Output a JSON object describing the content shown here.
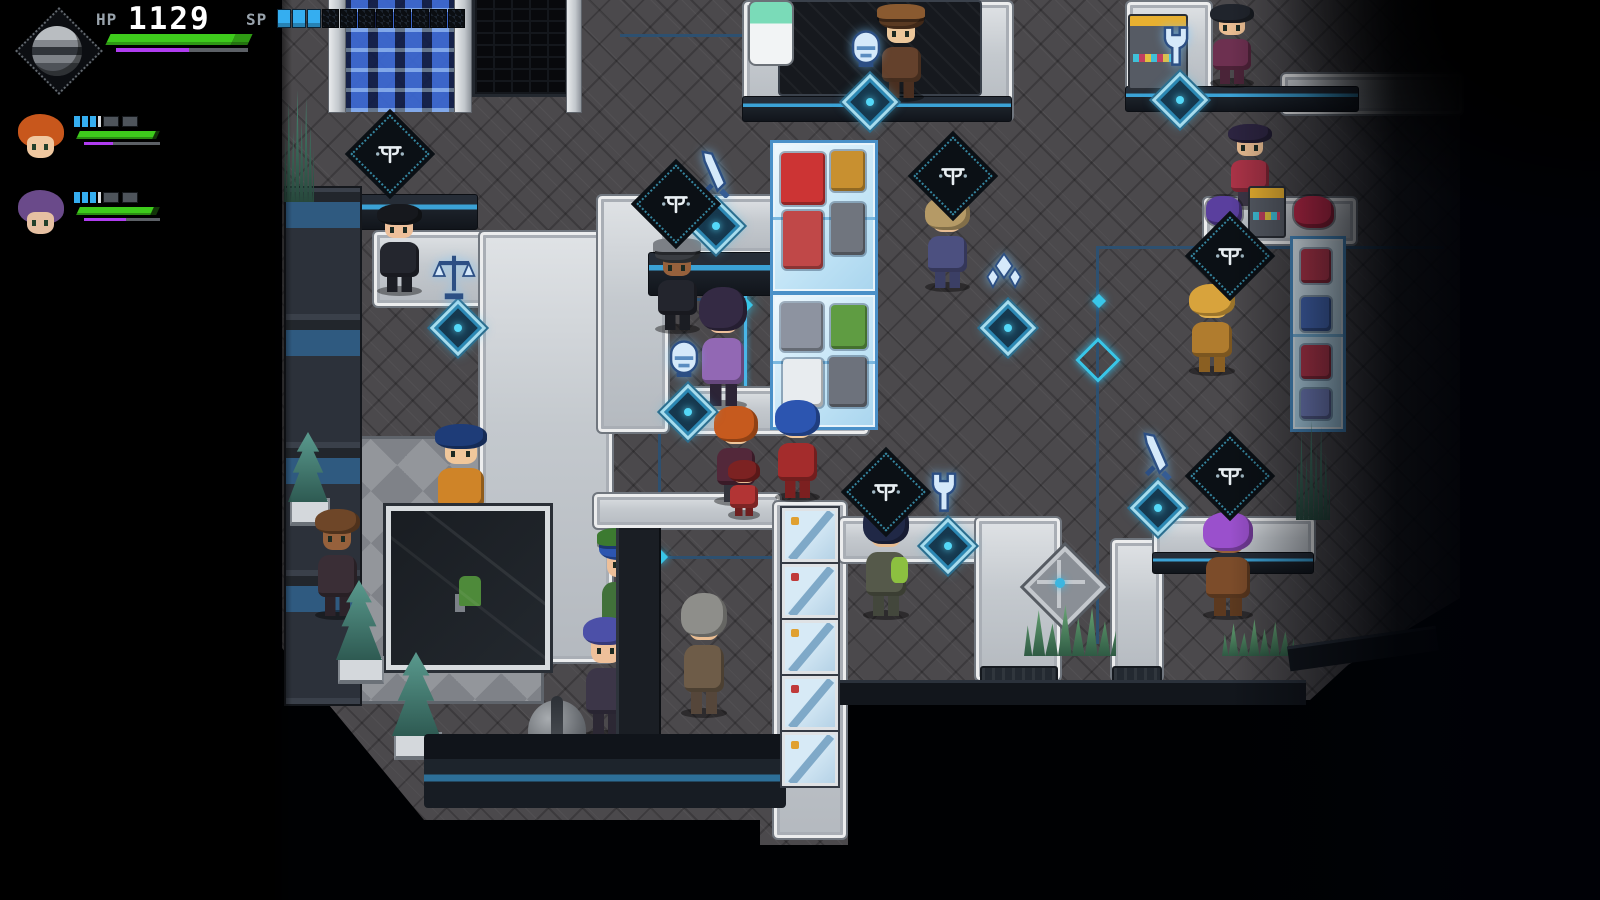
{
  "hud": {
    "hp_label": "HP",
    "hp_value": "1129",
    "sp_label": "SP",
    "hp_percent": 100,
    "buff_percent": 55,
    "sp_segments_filled": 3,
    "sp_segments_empty": 8,
    "colors": {
      "hp_bar": "#3ecb1c",
      "hp_bar_tip": "#2f9a14",
      "buff_bar": "#b03cf0",
      "bar_track": "#5c6066",
      "sp_filled": "#35aef0",
      "label_text": "#99a3ac",
      "value_text": "#ffffff"
    },
    "emblem_icon": "planet-emblem",
    "party": [
      {
        "id": "party-member-1",
        "hair": "#c8571c",
        "skin": "#f0c8a0",
        "sp_filled": 3,
        "sp_blocks": 2,
        "hp_percent": 95,
        "buff_percent": 38
      },
      {
        "id": "party-member-2",
        "hair": "#6a4a8a",
        "skin": "#e6c0a2",
        "sp_filled": 3,
        "sp_blocks": 2,
        "hp_percent": 93,
        "buff_percent": 55
      }
    ]
  },
  "scene": {
    "palette": {
      "floor": "#4b494c",
      "walkway": "#c6cad0",
      "accent_cyan": "#49b6e8",
      "glass": "#bfe4f7",
      "hologram": "#cfe4f6"
    },
    "paths": [
      {
        "x": 742,
        "y": 0,
        "w": 268,
        "h": 118
      },
      {
        "x": 778,
        "y": 0,
        "w": 200,
        "h": 92,
        "dark": true
      },
      {
        "x": 742,
        "y": 96,
        "w": 268,
        "h": 24,
        "front": true
      },
      {
        "x": 372,
        "y": 230,
        "w": 238,
        "h": 74
      },
      {
        "x": 478,
        "y": 230,
        "w": 132,
        "h": 430
      },
      {
        "x": 298,
        "y": 194,
        "w": 178,
        "h": 34,
        "front": true
      },
      {
        "x": 596,
        "y": 194,
        "w": 266,
        "h": 58
      },
      {
        "x": 596,
        "y": 194,
        "w": 70,
        "h": 236
      },
      {
        "x": 648,
        "y": 252,
        "w": 140,
        "h": 42,
        "front": true
      },
      {
        "x": 680,
        "y": 386,
        "w": 186,
        "h": 46
      },
      {
        "x": 592,
        "y": 492,
        "w": 186,
        "h": 34
      },
      {
        "x": 772,
        "y": 500,
        "w": 72,
        "h": 336
      },
      {
        "x": 838,
        "y": 516,
        "w": 186,
        "h": 44
      },
      {
        "x": 974,
        "y": 516,
        "w": 84,
        "h": 162
      },
      {
        "x": 980,
        "y": 666,
        "w": 74,
        "h": 24,
        "cap": true
      },
      {
        "x": 1110,
        "y": 538,
        "w": 50,
        "h": 140
      },
      {
        "x": 1112,
        "y": 666,
        "w": 46,
        "h": 22,
        "cap": true
      },
      {
        "x": 1152,
        "y": 516,
        "w": 160,
        "h": 44
      },
      {
        "x": 1152,
        "y": 552,
        "w": 160,
        "h": 20,
        "front": true
      },
      {
        "x": 1202,
        "y": 196,
        "w": 152,
        "h": 46
      },
      {
        "x": 1125,
        "y": 0,
        "w": 84,
        "h": 96
      },
      {
        "x": 1125,
        "y": 86,
        "w": 232,
        "h": 24,
        "front": true
      },
      {
        "x": 1280,
        "y": 72,
        "w": 180,
        "h": 40
      }
    ],
    "lines": [
      {
        "x": 620,
        "y": 34,
        "w": 126,
        "h": 3
      },
      {
        "x": 742,
        "y": 34,
        "w": 3,
        "h": 84
      },
      {
        "x": 744,
        "y": 214,
        "w": 3,
        "h": 196,
        "bright": true
      },
      {
        "x": 558,
        "y": 298,
        "w": 188,
        "h": 3
      },
      {
        "x": 658,
        "y": 298,
        "w": 3,
        "h": 262
      },
      {
        "x": 1096,
        "y": 246,
        "w": 348,
        "h": 3
      },
      {
        "x": 1096,
        "y": 246,
        "w": 3,
        "h": 398
      },
      {
        "x": 660,
        "y": 556,
        "w": 180,
        "h": 3
      },
      {
        "x": 430,
        "y": 762,
        "w": 356,
        "h": 5
      }
    ],
    "nodes": [
      {
        "x": 741,
        "y": 300,
        "bright": true
      },
      {
        "x": 1082,
        "y": 344,
        "big": true
      },
      {
        "x": 1094,
        "y": 296
      },
      {
        "x": 656,
        "y": 552
      }
    ],
    "signs": [
      {
        "icon": "shop-glyph",
        "x": 362,
        "y": 126
      },
      {
        "icon": "shop-glyph",
        "x": 648,
        "y": 176
      },
      {
        "icon": "sword",
        "x": 688,
        "y": 150,
        "medallion": true
      },
      {
        "icon": "shop-glyph",
        "x": 925,
        "y": 148
      },
      {
        "icon": "crystal",
        "x": 980,
        "y": 252,
        "medallion": true
      },
      {
        "icon": "pod",
        "x": 660,
        "y": 336,
        "medallion": true
      },
      {
        "icon": "pod",
        "x": 842,
        "y": 26,
        "medallion": true
      },
      {
        "icon": "wrench",
        "x": 1152,
        "y": 24,
        "medallion": true
      },
      {
        "icon": "shop-glyph",
        "x": 1202,
        "y": 228
      },
      {
        "icon": "scales",
        "x": 430,
        "y": 252,
        "medallion": true
      },
      {
        "icon": "shop-glyph",
        "x": 858,
        "y": 464
      },
      {
        "icon": "wrench",
        "x": 920,
        "y": 470,
        "medallion": true
      },
      {
        "icon": "sword",
        "x": 1130,
        "y": 432,
        "medallion": true
      },
      {
        "icon": "shop-glyph",
        "x": 1202,
        "y": 448
      }
    ],
    "cases": [
      {
        "x": 770,
        "y": 140,
        "w": 102,
        "h": 148,
        "items": [
          {
            "x": 8,
            "y": 10,
            "w": 44,
            "h": 52,
            "c": "#cc3434"
          },
          {
            "x": 58,
            "y": 8,
            "w": 34,
            "h": 40,
            "c": "#c89030"
          },
          {
            "x": 10,
            "y": 68,
            "w": 40,
            "h": 58,
            "c": "#c04848"
          },
          {
            "x": 58,
            "y": 60,
            "w": 34,
            "h": 52,
            "c": "#70757e"
          }
        ]
      },
      {
        "x": 770,
        "y": 292,
        "w": 102,
        "h": 132,
        "items": [
          {
            "x": 8,
            "y": 8,
            "w": 42,
            "h": 48,
            "c": "#8d93a0"
          },
          {
            "x": 58,
            "y": 10,
            "w": 36,
            "h": 44,
            "c": "#5f9c42"
          },
          {
            "x": 10,
            "y": 64,
            "w": 40,
            "h": 48,
            "c": "#e8ecef"
          },
          {
            "x": 56,
            "y": 62,
            "w": 38,
            "h": 50,
            "c": "#6d727c"
          }
        ]
      },
      {
        "x": 1290,
        "y": 236,
        "w": 50,
        "h": 190,
        "items": [
          {
            "x": 8,
            "y": 10,
            "w": 30,
            "h": 34,
            "c": "#c03a50"
          },
          {
            "x": 8,
            "y": 58,
            "w": 30,
            "h": 34,
            "c": "#4a6fc0"
          },
          {
            "x": 8,
            "y": 106,
            "w": 30,
            "h": 34,
            "c": "#c03a50"
          },
          {
            "x": 8,
            "y": 150,
            "w": 30,
            "h": 30,
            "c": "#7a87c8"
          }
        ]
      }
    ],
    "posters": {
      "x": 782,
      "y": 508,
      "count": 5
    },
    "npcs": [
      {
        "name": "green-soldier",
        "x": 1438,
        "y": 0,
        "w": 36,
        "h": 62,
        "hair": "#3f6a2c",
        "skin": "#d8b088",
        "body": "#2f5226",
        "legs": "#233c1c",
        "face": false
      },
      {
        "name": "hat-merchant",
        "x": 876,
        "y": 4,
        "w": 50,
        "h": 98,
        "hair": "#5a3a22",
        "skin": "#ecc79b",
        "body": "#64412c",
        "legs": "#4a2f20",
        "face": true,
        "hat": "#8a5a30"
      },
      {
        "name": "top-right-clerk",
        "x": 1208,
        "y": 0,
        "w": 48,
        "h": 88,
        "hair": "#20242c",
        "skin": "#eabd92",
        "body": "#6d3050",
        "legs": "#4a2438",
        "face": true
      },
      {
        "name": "red-shirt-clerk",
        "x": 1226,
        "y": 120,
        "w": 48,
        "h": 90,
        "hair": "#2c2440",
        "skin": "#eabd92",
        "body": "#ab3347",
        "legs": "#3c3646",
        "face": true
      },
      {
        "name": "long-hair-clerk",
        "x": 374,
        "y": 200,
        "w": 50,
        "h": 96,
        "hair": "#16181d",
        "skin": "#eec09a",
        "body": "#24262e",
        "legs": "#1c1e24",
        "face": true
      },
      {
        "name": "suit-clerk",
        "x": 652,
        "y": 238,
        "w": 50,
        "h": 96,
        "hair": "#3a3d42",
        "skin": "#96613c",
        "body": "#23252d",
        "legs": "#1b1d23",
        "face": true,
        "hat": "#7c8086"
      },
      {
        "name": "sandy-hair-man",
        "x": 922,
        "y": 192,
        "w": 50,
        "h": 100,
        "hair": "#b59a66",
        "skin": "#e8bd92",
        "body": "#4c5080",
        "legs": "#3b3f65",
        "face": false
      },
      {
        "name": "purple-coat-lady",
        "x": 696,
        "y": 282,
        "w": 54,
        "h": 128,
        "hair": "#342a44",
        "skin": "#eec09a",
        "body": "#9268b4",
        "legs": "#2c2436",
        "face": false
      },
      {
        "name": "gold-bird-creature",
        "x": 1186,
        "y": 280,
        "w": 52,
        "h": 96,
        "hair": "#d8a33c",
        "skin": "#e0b050",
        "body": "#b07c2e",
        "legs": "#8a5f22",
        "face": false
      },
      {
        "name": "player-lea",
        "x": 712,
        "y": 402,
        "w": 48,
        "h": 104,
        "hair": "#c65a1e",
        "skin": "#f0c79b",
        "body": "#53283a",
        "legs": "#32343c",
        "face": false
      },
      {
        "name": "blue-hair-ally",
        "x": 772,
        "y": 396,
        "w": 50,
        "h": 106,
        "hair": "#2c55b0",
        "skin": "#f0c79b",
        "body": "#a42c2c",
        "legs": "#7c2020",
        "face": false
      },
      {
        "name": "blue-afro-clerk",
        "x": 432,
        "y": 420,
        "w": 58,
        "h": 110,
        "hair": "#1e3c78",
        "skin": "#f0c79b",
        "body": "#cf8428",
        "legs": "#2c2c30",
        "face": true
      },
      {
        "name": "tiny-red-npc",
        "x": 726,
        "y": 458,
        "w": 36,
        "h": 62,
        "hair": "#7c2222",
        "skin": "#eabd92",
        "body": "#b23434",
        "legs": "#6e1f1f",
        "face": false
      },
      {
        "name": "green-bag-man",
        "x": 860,
        "y": 498,
        "w": 52,
        "h": 122,
        "hair": "#202846",
        "skin": "#e8bd92",
        "body": "#55594a",
        "legs": "#43473c",
        "face": false,
        "extra": "#8cc040"
      },
      {
        "name": "brown-bob-npc",
        "x": 312,
        "y": 504,
        "w": 50,
        "h": 116,
        "hair": "#6e4628",
        "skin": "#96613c",
        "body": "#3a2e36",
        "legs": "#2c232a",
        "face": true
      },
      {
        "name": "green-cap-npc",
        "x": 596,
        "y": 528,
        "w": 52,
        "h": 122,
        "hair": "#2c55b0",
        "skin": "#eec09a",
        "body": "#41713a",
        "legs": "#31542c",
        "face": true,
        "hat": "#3c7a30"
      },
      {
        "name": "purple-spiky-npc",
        "x": 1200,
        "y": 508,
        "w": 56,
        "h": 112,
        "hair": "#9a50cc",
        "skin": "#96613c",
        "body": "#7c4c2a",
        "legs": "#5c391f",
        "face": false
      },
      {
        "name": "blue-hair-girl",
        "x": 580,
        "y": 612,
        "w": 52,
        "h": 128,
        "hair": "#4c50a8",
        "skin": "#eec09a",
        "body": "#3c3648",
        "legs": "#2c2834",
        "face": true
      },
      {
        "name": "gray-coat-walker",
        "x": 678,
        "y": 588,
        "w": 52,
        "h": 130,
        "hair": "#8e8e8a",
        "skin": "#eabd92",
        "body": "#6e5c48",
        "legs": "#55463a",
        "face": false
      }
    ],
    "entity_bars": [
      {
        "x": 713,
        "y": 407,
        "w": 48
      },
      {
        "x": 720,
        "y": 520,
        "w": 48
      }
    ],
    "plants": [
      {
        "type": "pine",
        "x": 288,
        "y": 432,
        "w": 40,
        "h": 70
      },
      {
        "type": "pine",
        "x": 336,
        "y": 580,
        "w": 46,
        "h": 80
      },
      {
        "type": "pine",
        "x": 392,
        "y": 652,
        "w": 48,
        "h": 84
      },
      {
        "type": "tall",
        "x": 284,
        "y": 80,
        "w": 30,
        "h": 122
      },
      {
        "type": "tall",
        "x": 1296,
        "y": 412,
        "w": 34,
        "h": 108
      },
      {
        "type": "grass",
        "x": 648,
        "y": 752,
        "w": 96,
        "h": 40
      },
      {
        "type": "grass",
        "x": 1024,
        "y": 600,
        "w": 92,
        "h": 56,
        "planter": true
      },
      {
        "type": "grass",
        "x": 1222,
        "y": 616,
        "w": 72,
        "h": 40
      }
    ],
    "props": [
      {
        "type": "platform",
        "x": 316,
        "y": 436,
        "w": 222,
        "h": 262
      },
      {
        "type": "plantcase",
        "x": 386,
        "y": 506,
        "w": 154,
        "h": 154
      },
      {
        "type": "bench",
        "x": 424,
        "y": 734,
        "w": 362,
        "h": 74
      },
      {
        "type": "kiosks",
        "x": 284,
        "y": 186,
        "w": 74,
        "h": 516
      },
      {
        "type": "pillar",
        "x": 328,
        "y": 0,
        "w": 16,
        "h": 112
      },
      {
        "type": "crystals",
        "x": 346,
        "y": 0,
        "w": 108,
        "h": 112
      },
      {
        "type": "pillar",
        "x": 454,
        "y": 0,
        "w": 16,
        "h": 112
      },
      {
        "type": "doorway",
        "x": 472,
        "y": 0,
        "w": 92,
        "h": 94
      },
      {
        "type": "pillar",
        "x": 566,
        "y": 0,
        "w": 14,
        "h": 112
      },
      {
        "type": "capsule",
        "x": 748,
        "y": 0,
        "w": 42,
        "h": 62
      },
      {
        "type": "machine",
        "x": 1128,
        "y": 14,
        "w": 56,
        "h": 72
      },
      {
        "type": "machine",
        "x": 1248,
        "y": 186,
        "w": 34,
        "h": 48
      },
      {
        "type": "blob",
        "x": 1206,
        "y": 196,
        "w": 36,
        "h": 30,
        "c": "#5a3f9e"
      },
      {
        "type": "blob",
        "x": 1294,
        "y": 196,
        "w": 40,
        "h": 32,
        "c": "#c32a4a"
      },
      {
        "type": "ornament",
        "x": 1028,
        "y": 548,
        "w": 66,
        "h": 74
      },
      {
        "type": "darkwall",
        "x": 616,
        "y": 528,
        "w": 40,
        "h": 228
      },
      {
        "type": "robot",
        "x": 520,
        "y": 694,
        "w": 74,
        "h": 84
      },
      {
        "type": "edge",
        "x": 836,
        "y": 680,
        "w": 470,
        "h": 22
      },
      {
        "type": "edge2",
        "x": 1288,
        "y": 636,
        "w": 150,
        "h": 22
      }
    ]
  }
}
